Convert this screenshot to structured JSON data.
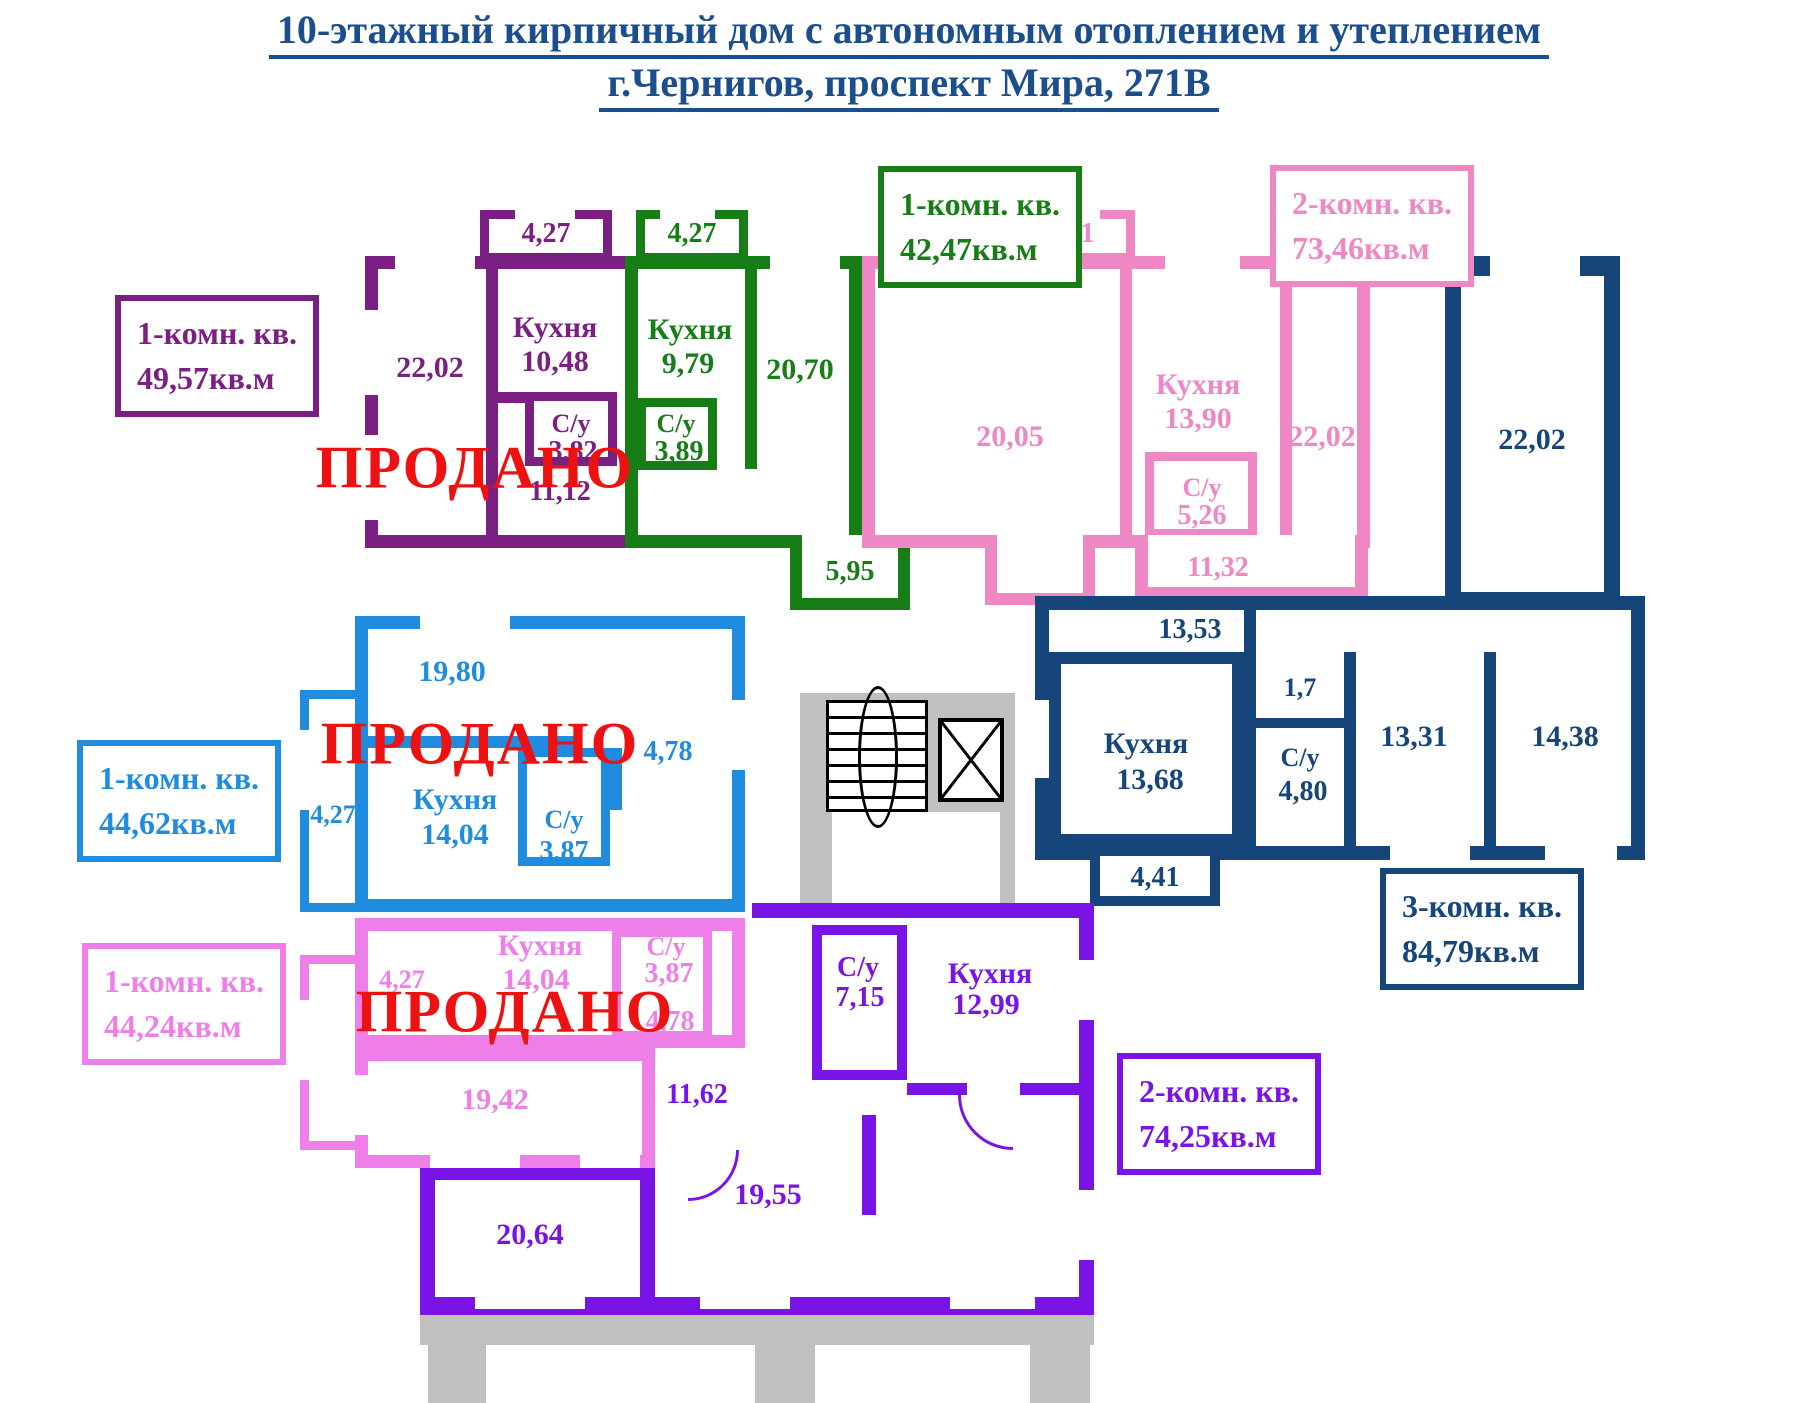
{
  "title": {
    "line1": "10-этажный кирпичный дом с автономным отоплением и утеплением",
    "line2": "г.Чернигов, проспект Мира, 271В"
  },
  "title_color": "#1B4E8C",
  "structure_color": "#C0C0C0",
  "sold_color": "#EE1111",
  "stamp_text": "ПРОДАНО",
  "apartments": [
    {
      "name": "apt-1k-4957",
      "type_label": "1-комн. кв.",
      "area_label": "49,57кв.м",
      "color": "#7B1F82",
      "sold": true,
      "rooms": {
        "balcony": "4,27",
        "room": "22,02",
        "kitchen_name": "Кухня",
        "kitchen_area": "10,48",
        "wc_name": "С/у",
        "wc_area": "3,82",
        "hall": "11,12"
      }
    },
    {
      "name": "apt-1k-4247",
      "type_label": "1-комн. кв.",
      "area_label": "42,47кв.м",
      "color": "#177D17",
      "sold": false,
      "rooms": {
        "balcony": "4,27",
        "kitchen_name": "Кухня",
        "kitchen_area": "9,79",
        "wc_name": "С/у",
        "wc_area": "3,89",
        "room": "20,70",
        "hall": "5,95"
      }
    },
    {
      "name": "apt-2k-7346",
      "type_label": "2-комн. кв.",
      "area_label": "73,46кв.м",
      "color": "#EF87C5",
      "sold": false,
      "rooms": {
        "balcony": "4,41",
        "room1": "20,05",
        "kitchen_name": "Кухня",
        "kitchen_area": "13,90",
        "wc_name": "С/у",
        "wc_area": "5,26",
        "hall": "11,32",
        "room2": "22,02"
      }
    },
    {
      "name": "apt-3k-8479",
      "type_label": "3-комн. кв.",
      "area_label": "84,79кв.м",
      "color": "#16457A",
      "sold": false,
      "rooms": {
        "room1": "22,02",
        "hall": "13,53",
        "kitchen_name": "Кухня",
        "kitchen_area": "13,68",
        "closet": "1,7",
        "wc_name": "С/у",
        "wc_area": "4,80",
        "room2": "13,31",
        "room3": "14,38",
        "balcony": "4,41"
      }
    },
    {
      "name": "apt-1k-4462",
      "type_label": "1-комн. кв.",
      "area_label": "44,62кв.м",
      "color": "#1F8CE0",
      "sold": true,
      "rooms": {
        "room": "19,80",
        "balcony": "4,27",
        "kitchen_name": "Кухня",
        "kitchen_area": "14,04",
        "wc_name": "С/у",
        "wc_area": "3,87",
        "hall": "4,78"
      }
    },
    {
      "name": "apt-1k-4424",
      "type_label": "1-комн. кв.",
      "area_label": "44,24кв.м",
      "color": "#EE7FE8",
      "sold": true,
      "rooms": {
        "balcony": "4,27",
        "kitchen_name": "Кухня",
        "kitchen_area": "14,04",
        "wc_name": "С/у",
        "wc_area": "3,87",
        "hall": "4,78",
        "room": "19,42"
      }
    },
    {
      "name": "apt-2k-7425",
      "type_label": "2-комн. кв.",
      "area_label": "74,25кв.м",
      "color": "#7A14E6",
      "sold": false,
      "rooms": {
        "wc_name": "С/у",
        "wc_area": "7,15",
        "kitchen_name": "Кухня",
        "kitchen_area": "12,99",
        "hall": "11,62",
        "room1": "20,64",
        "room2": "19,55"
      }
    }
  ]
}
